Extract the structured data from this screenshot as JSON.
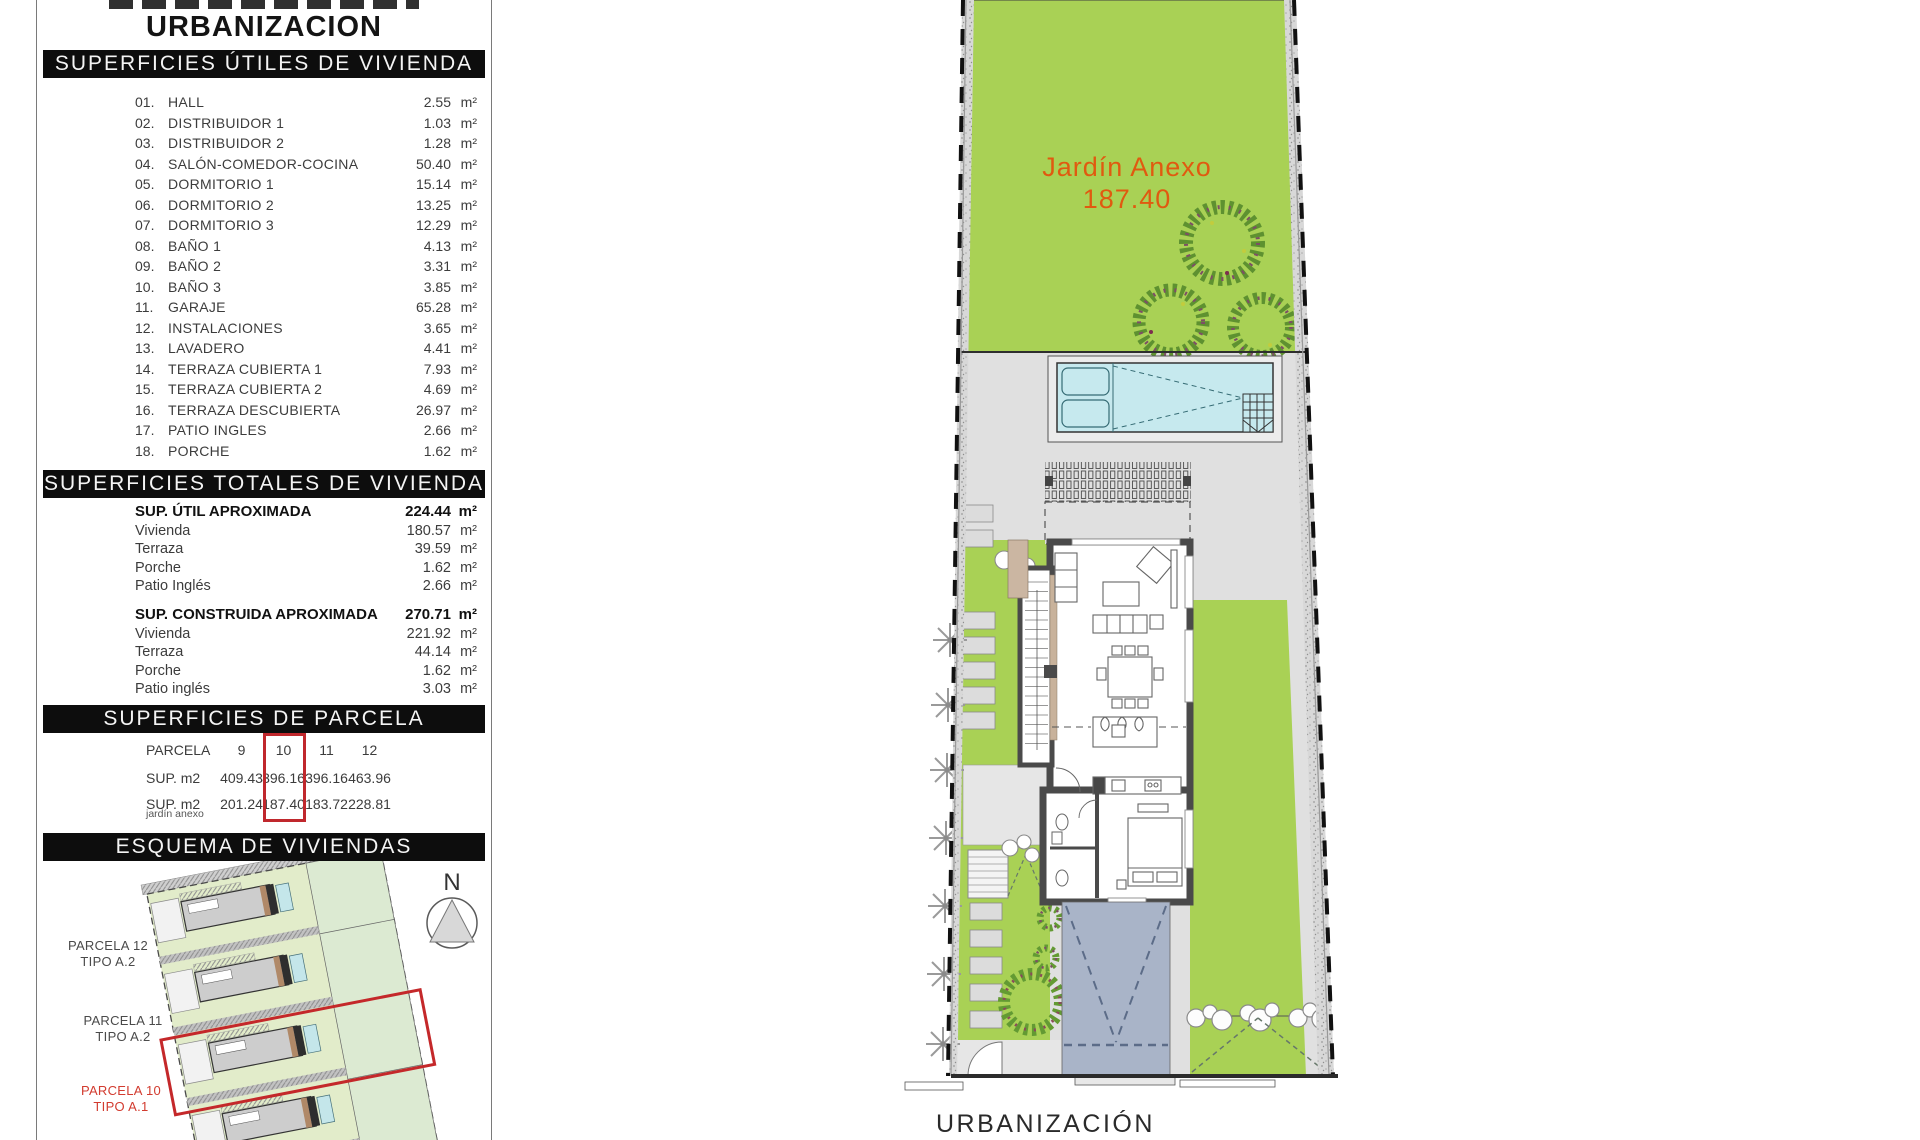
{
  "left_panel": {
    "top_title": "URBANIZACION",
    "utiles": {
      "header": "SUPERFICIES ÚTILES DE VIVIENDA",
      "unit": "m²",
      "rows": [
        [
          "01.",
          "HALL",
          "2.55"
        ],
        [
          "02.",
          "DISTRIBUIDOR 1",
          "1.03"
        ],
        [
          "03.",
          "DISTRIBUIDOR 2",
          "1.28"
        ],
        [
          "04.",
          "SALÓN-COMEDOR-COCINA",
          "50.40"
        ],
        [
          "05.",
          "DORMITORIO 1",
          "15.14"
        ],
        [
          "06.",
          "DORMITORIO 2",
          "13.25"
        ],
        [
          "07.",
          "DORMITORIO 3",
          "12.29"
        ],
        [
          "08.",
          "BAÑO 1",
          "4.13"
        ],
        [
          "09.",
          "BAÑO 2",
          "3.31"
        ],
        [
          "10.",
          "BAÑO 3",
          "3.85"
        ],
        [
          "11.",
          "GARAJE",
          "65.28"
        ],
        [
          "12.",
          "INSTALACIONES",
          "3.65"
        ],
        [
          "13.",
          "LAVADERO",
          "4.41"
        ],
        [
          "14.",
          "TERRAZA CUBIERTA 1",
          "7.93"
        ],
        [
          "15.",
          "TERRAZA CUBIERTA 2",
          "4.69"
        ],
        [
          "16.",
          "TERRAZA DESCUBIERTA",
          "26.97"
        ],
        [
          "17.",
          "PATIO INGLES",
          "2.66"
        ],
        [
          "18.",
          "PORCHE",
          "1.62"
        ]
      ]
    },
    "totales": {
      "header": "SUPERFICIES TOTALES DE VIVIENDA",
      "unit": "m²",
      "groups": [
        {
          "title": "SUP. ÚTIL APROXIMADA",
          "value": "224.44",
          "rows": [
            [
              "Vivienda",
              "180.57"
            ],
            [
              "Terraza",
              "39.59"
            ],
            [
              "Porche",
              "1.62"
            ],
            [
              "Patio Inglés",
              "2.66"
            ]
          ]
        },
        {
          "title": "SUP. CONSTRUIDA APROXIMADA",
          "value": "270.71",
          "rows": [
            [
              "Vivienda",
              "221.92"
            ],
            [
              "Terraza",
              "44.14"
            ],
            [
              "Porche",
              "1.62"
            ],
            [
              "Patio inglés",
              "3.03"
            ]
          ]
        }
      ]
    },
    "parcela": {
      "header": "SUPERFICIES DE PARCELA",
      "row_label": "PARCELA",
      "ids": [
        "9",
        "10",
        "11",
        "12"
      ],
      "sup_label": "SUP. m2",
      "sup_values": [
        "409.43",
        "396.16",
        "396.16",
        "463.96"
      ],
      "jardin_label": "SUP. m2",
      "jardin_sublabel": "jardín anexo",
      "jardin_values": [
        "201.24",
        "187.40",
        "183.72",
        "228.81"
      ],
      "highlighted": "10"
    },
    "esquema": {
      "header": "ESQUEMA DE VIVIENDAS",
      "compass": "N",
      "labels": [
        {
          "line1": "PARCELA 12",
          "line2": "TIPO A.2",
          "red": false
        },
        {
          "line1": "PARCELA 11",
          "line2": "TIPO A.2",
          "red": false
        },
        {
          "line1": "PARCELA 10",
          "line2": "TIPO A.1",
          "red": true
        }
      ]
    }
  },
  "plan": {
    "garden_label": "Jardín Anexo",
    "garden_value": "187.40",
    "bottom_label": "URBANIZACIÓN"
  },
  "colors": {
    "garden_green": "#a9d155",
    "pale_green": "#e2ecca",
    "pool_blue": "#c6e9ee",
    "driveway_blue": "#a9b4c8",
    "highlight_red": "#c0282d",
    "label_orange": "#e05a10",
    "bar_black": "#0d0d0d"
  }
}
